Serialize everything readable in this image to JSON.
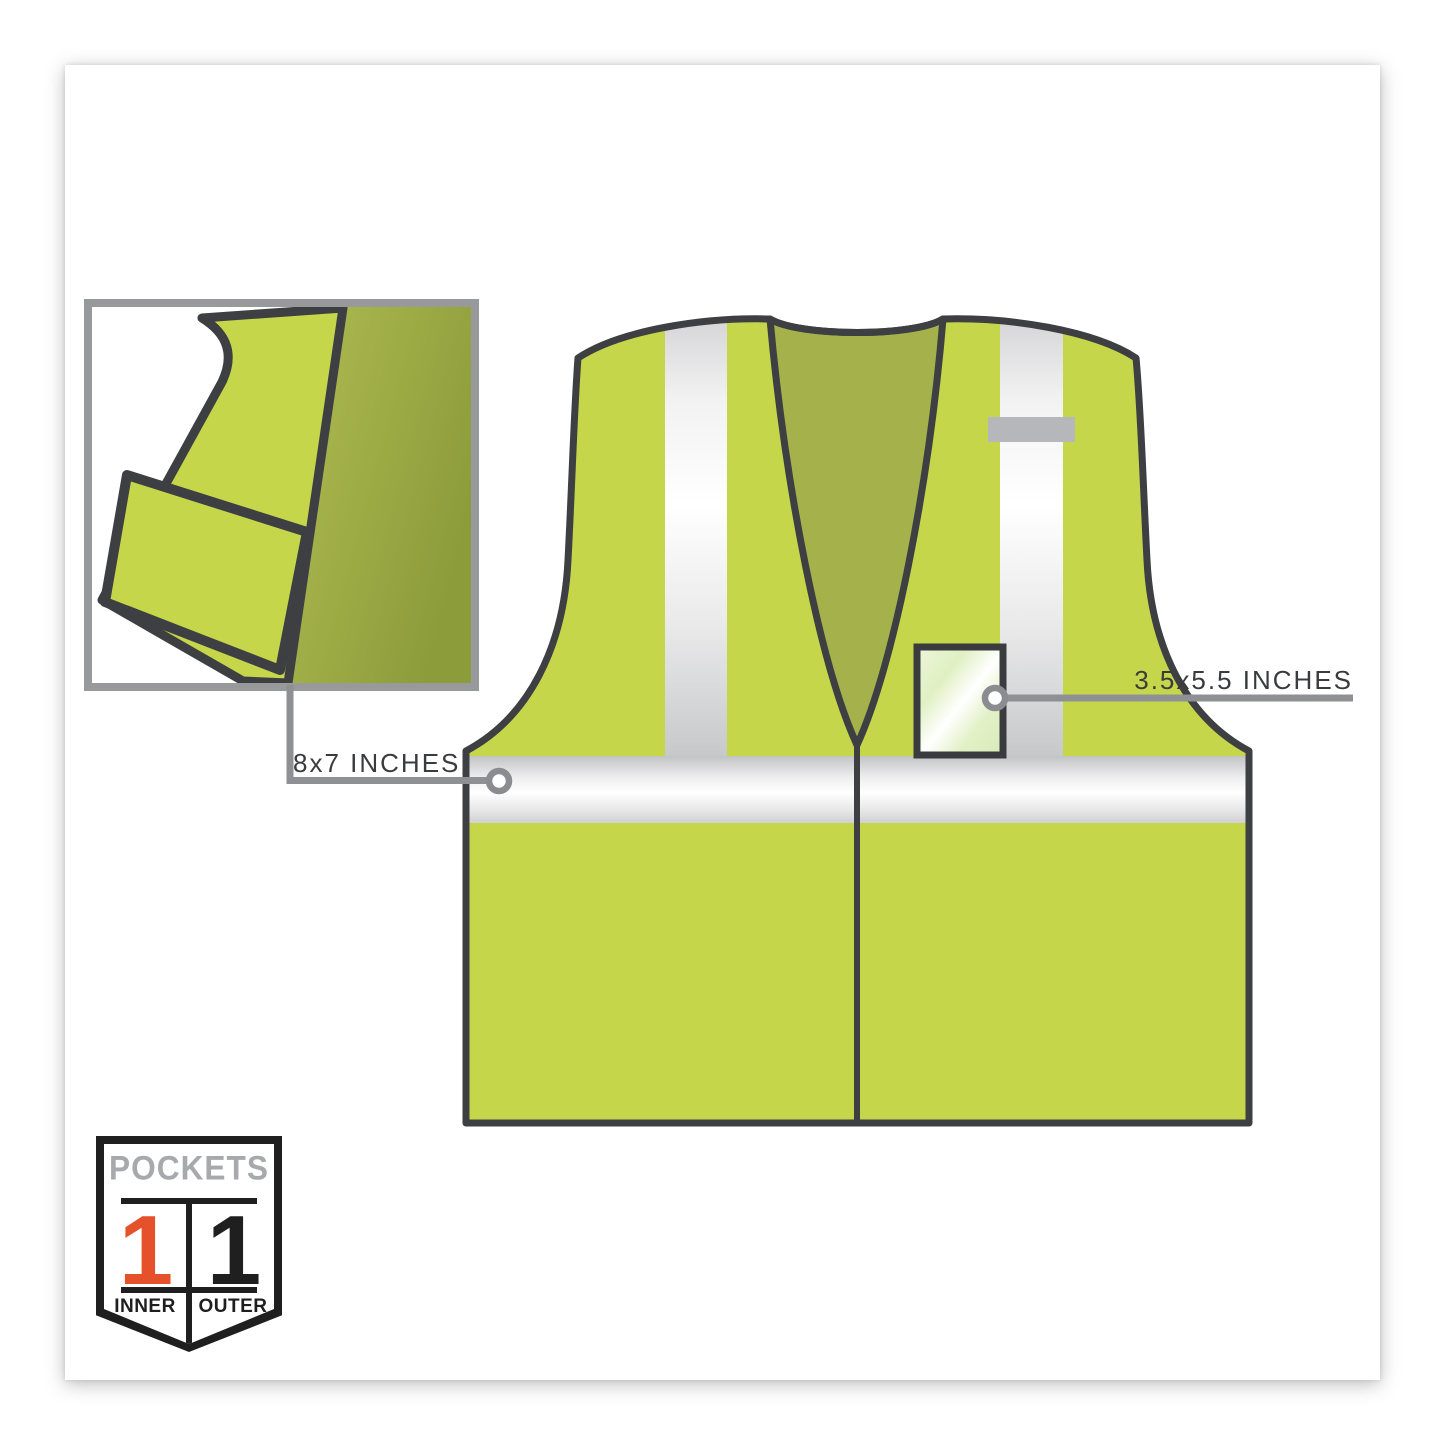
{
  "page": {
    "background": "#ffffff",
    "card_background": "#ffffff",
    "description": "hi-vis safety vest product diagram"
  },
  "colors": {
    "vest_lime": "#c6d64b",
    "vest_inside_olive": "#a5b14b",
    "vest_outline": "#3e3f43",
    "reflective_stripe_light": "#ffffff",
    "reflective_stripe_dark": "#c7c8ca",
    "callout_gray": "#8e9093",
    "inset_border_gray": "#97999b",
    "shoulder_tab_gray": "#b6b7ba",
    "accent_orange": "#e4512b",
    "badge_title_gray": "#a7a9ac",
    "badge_black": "#1f1f1f"
  },
  "illustration": {
    "main": "hi-vis safety vest, front view",
    "inset": "vest corner folded open showing inner pocket"
  },
  "callouts": {
    "inner_pocket": {
      "label": "8x7 INCHES"
    },
    "badge_pocket": {
      "label": "3.5x5.5 INCHES"
    }
  },
  "pockets_badge": {
    "title": "POCKETS",
    "columns": [
      {
        "count": "1",
        "label": "INNER"
      },
      {
        "count": "1",
        "label": "OUTER"
      }
    ]
  }
}
